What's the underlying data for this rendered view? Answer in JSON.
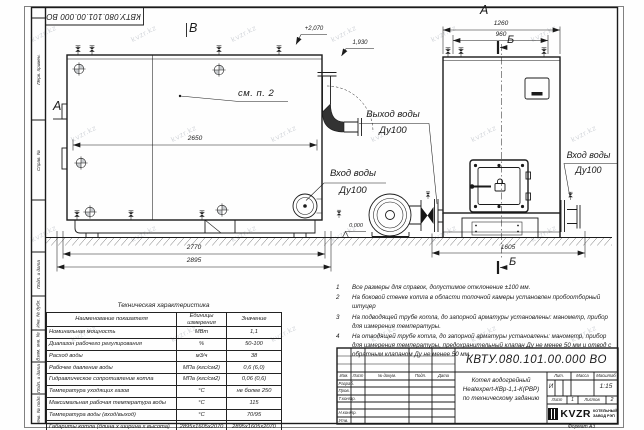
{
  "frame": {
    "designation_top": "КВТУ.080.101.00.000 ВО",
    "strip_labels": [
      "Перв. примен.",
      "Справ. №",
      "Подп. и дата",
      "Инв. № дубл.",
      "Взам. инв. №",
      "Подп. и дата",
      "Инв. № подл."
    ],
    "format_note": "Формат А3"
  },
  "views": {
    "left": {
      "label_top": "В",
      "label_side": "А",
      "callout": "см. п. 2",
      "dim_mid": "2650",
      "dim_bottom_inner": "2770",
      "dim_bottom_outer": "2895",
      "elev_top": "+2,070",
      "elev_mid": "1,930",
      "elev_zero": "0.000",
      "outlet_label": "Выход воды",
      "outlet_dn": "Ду100",
      "inlet_label": "Вход воды",
      "inlet_dn": "Ду100"
    },
    "right": {
      "label": "А",
      "section": "Б",
      "dim_top_outer": "1260",
      "dim_top_inner": "960",
      "dim_bottom": "1605",
      "inlet_label": "Вход воды",
      "inlet_dn": "Ду100"
    }
  },
  "notes": [
    {
      "num": "1",
      "text": "Все размеры для справок, допустимое отклонение ±100 мм."
    },
    {
      "num": "2",
      "text": "На боковой стенке котла в области топочной камеры установлен пробоотборный штуцер"
    },
    {
      "num": "3",
      "text": "На подводящей трубе котла, до запорной арматуры установлены: манометр, прибор для измерения температуры."
    },
    {
      "num": "4",
      "text": "На отводящей трубе котла, до запорной арматуры установлены: манометр, прибор для измерения температуры, предохранительный клапан Ду не менее 50 мм и отвод с обратным клапаном Ду не менее 50 мм."
    }
  ],
  "tech_table": {
    "title": "Техническая характеристика",
    "headers": [
      "Наименование показателя",
      "Единицы измерения",
      "Значение"
    ],
    "rows": [
      {
        "name": "Номинальная мощность",
        "unit": "МВт",
        "value": "1,1"
      },
      {
        "name": "Диапазон рабочего регулирования",
        "unit": "%",
        "value": "50-100"
      },
      {
        "name": "Расход воды",
        "unit": "м3/ч",
        "value": "38"
      },
      {
        "name": "Рабочее давление воды",
        "unit": "МПа (кгс/см2)",
        "value": "0,6 (6,0)"
      },
      {
        "name": "Гидравлическое сопротивление котла",
        "unit": "МПа (кгс/см2)",
        "value": "0,06 (0,6)"
      },
      {
        "name": "Температура уходящих газов",
        "unit": "°С",
        "value": "не более 250"
      },
      {
        "name": "Максимальная рабочая температура воды",
        "unit": "°С",
        "value": "115"
      },
      {
        "name": "Температура воды (вход/выход)",
        "unit": "°С",
        "value": "70/95"
      },
      {
        "name": "Габариты котла (длина х ширина х высота)",
        "unit": "мм",
        "value": "2895х1605х2070"
      }
    ]
  },
  "title_block": {
    "designation": "КВТУ.080.101.00.000 ВО",
    "name_line1": "Котел водогрейный",
    "name_line2": "Heatexpert-КВр-1,1-К(РВР)",
    "name_line3": "по техническому заданию",
    "columns": [
      "Изм.",
      "Лист",
      "№ докум.",
      "Подп.",
      "Дата"
    ],
    "row_labels": [
      "Разраб.",
      "Пров.",
      "Т.контр.",
      "Н.контр.",
      "Утв."
    ],
    "lit_label": "Лит.",
    "mass_label": "Масса",
    "scale_label": "Масштаб",
    "lit_value": "И",
    "scale_value": "1:15",
    "sheet_label": "Лист",
    "sheet_value": "1",
    "sheets_label": "Листов",
    "sheets_value": "2",
    "logo_text": "KVZR",
    "company_line1": "КОТЕЛЬНЫЙ",
    "company_line2": "ЗАВОД РЭП"
  },
  "watermark": "kvzr.kz"
}
